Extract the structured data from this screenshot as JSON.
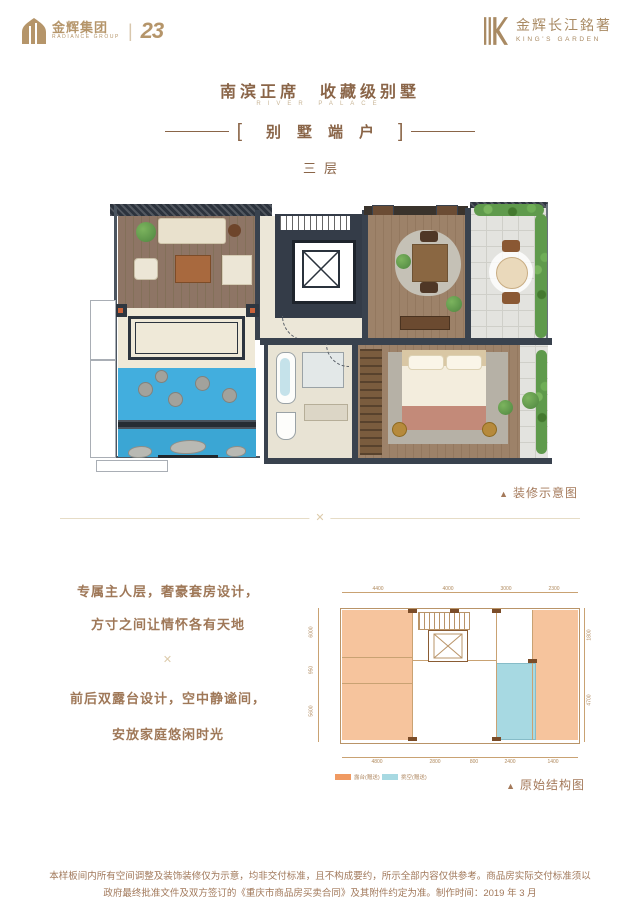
{
  "header": {
    "radiance": {
      "cn": "金辉集团",
      "en": "RADIANCE GROUP",
      "anniversary": "23"
    },
    "kings": {
      "cn": "金辉长江銘著",
      "en": "KING'S GARDEN"
    }
  },
  "title": {
    "main": "南滨正席　收藏级别墅",
    "sub_en": "RIVER PALACE",
    "bracket_left": "[",
    "bracket_right": "]",
    "unit": "别墅端户",
    "floor": "三层"
  },
  "decorated_plan": {
    "marker": "▲",
    "caption": "装修示意图"
  },
  "body_text": {
    "lines": [
      "专属主人层，奢豪套房设计，",
      "方寸之间让情怀各有天地",
      "前后双露台设计，空中静谧间，",
      "安放家庭悠闲时光"
    ],
    "ornament": "✕"
  },
  "divider_ornament": "✕",
  "structural_plan": {
    "marker": "▲",
    "caption": "原始结构图",
    "legend": [
      {
        "label": "露台(赠送)",
        "color": "#f09a62"
      },
      {
        "label": "挑空(赠送)",
        "color": "#a7d9e2"
      }
    ],
    "dims": {
      "top": [
        "4400",
        "4000",
        "3000",
        "2300"
      ],
      "bottom": [
        "4800",
        "2800",
        "800",
        "2400",
        "1400"
      ],
      "left": [
        "6000",
        "950",
        "5600"
      ],
      "right": [
        "1800",
        "4700"
      ]
    }
  },
  "footer": {
    "lines": [
      "本样板间内所有空间调整及装饰装修仅为示意，均非交付标准，且不构成要约，所示全部内容仅供参考。商品房实际交付标准须以",
      "政府最终批准文件及双方签订的《重庆市商品房买卖合同》及其附件约定为准。制作时间：2019 年 3 月"
    ]
  },
  "colors": {
    "accent_bronze": "#b5956a",
    "title_brown": "#8a6548",
    "body_brown": "#9f7858",
    "wall_dark": "#39424e",
    "pool_blue": "#42aede",
    "terrace_orange": "#f6c49d",
    "void_cyan": "#a7d9e2"
  }
}
